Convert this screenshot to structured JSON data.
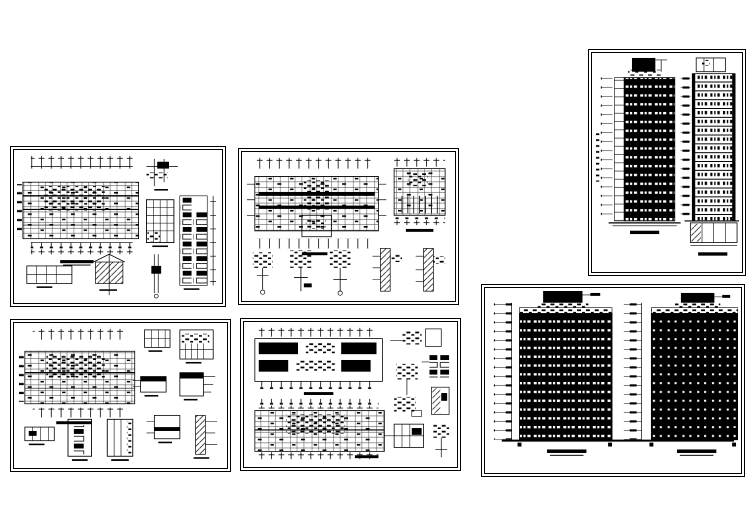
{
  "document": {
    "kind": "architectural-cad-drawing-set",
    "sheet_count": 6,
    "text_legibility": "captions and dimension text are below legible resolution"
  },
  "colors": {
    "ink": "#000000",
    "paper": "#ffffff"
  },
  "sheets": [
    {
      "id": "plan-details-a",
      "kind": "floor plan with wall and window details"
    },
    {
      "id": "plan-details-b",
      "kind": "two floor plans with five section details"
    },
    {
      "id": "elevations-a",
      "kind": "two high-rise tower elevations",
      "floors_visible": 18
    },
    {
      "id": "plan-details-c",
      "kind": "floor plan with door and section details"
    },
    {
      "id": "plan-details-d",
      "kind": "two stacked floor plans with detail callouts"
    },
    {
      "id": "elevations-b",
      "kind": "two high-rise tower elevations",
      "floors_visible": 16
    }
  ]
}
